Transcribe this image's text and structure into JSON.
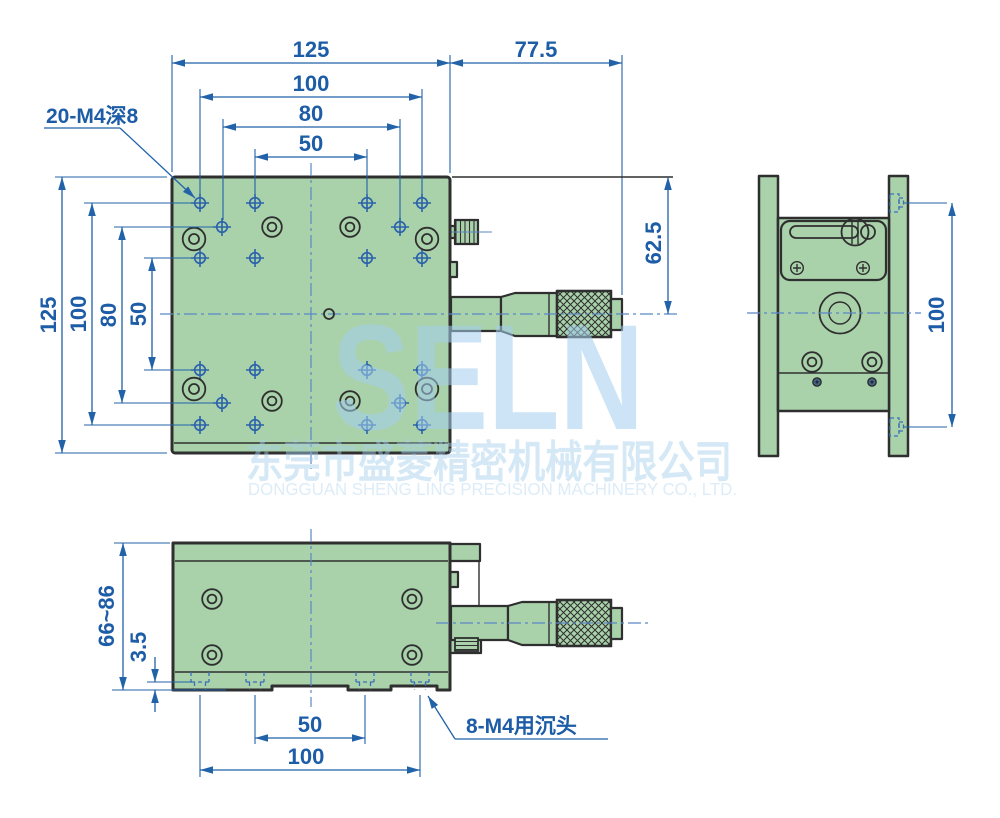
{
  "top_view": {
    "dim_h_125": "125",
    "dim_h_77_5": "77.5",
    "dim_h_100": "100",
    "dim_h_80": "80",
    "dim_h_50": "50",
    "dim_v_125": "125",
    "dim_v_100": "100",
    "dim_v_80": "80",
    "dim_v_50": "50",
    "dim_62_5": "62.5",
    "hole_note": "20-M4深8"
  },
  "side_view": {
    "dim_v_100": "100"
  },
  "front_view": {
    "dim_v_66_86": "66~86",
    "dim_v_3_5": "3.5",
    "dim_h_50": "50",
    "dim_h_100": "100",
    "hole_note": "8-M4用沉头"
  },
  "watermark": {
    "logo": "SELN",
    "company_cn": "东莞市盛菱精密机械有限公司",
    "company_en": "DONGGUAN SHENG LING PRECISION MACHINERY CO., LTD."
  },
  "colors": {
    "body_green": "#a9d2ab",
    "outline_dark": "#2f2f2f",
    "dimension_blue": "#2162a9",
    "centerline_blue": "#5b87c5",
    "watermark_blue": "#a4ceed"
  }
}
